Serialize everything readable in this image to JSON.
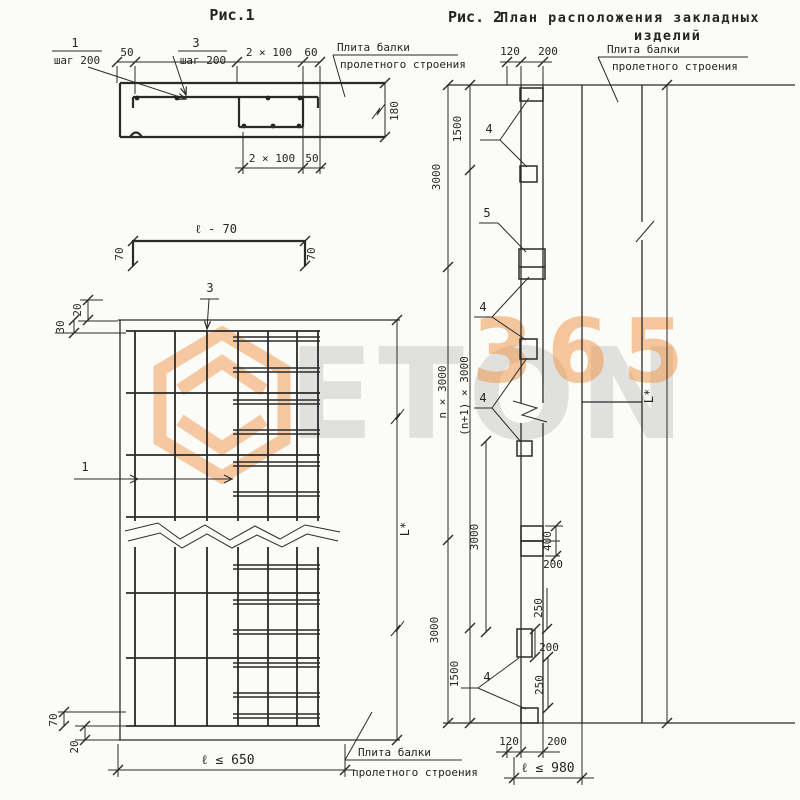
{
  "fig1": {
    "title": "Рис.1",
    "section": {
      "pos1": "1",
      "pos1_step": "шаг 200",
      "pos3": "3",
      "pos3_step": "шаг 200",
      "dim_50_top": "50",
      "dim_2x100_top": "2 × 100",
      "dim_60": "60",
      "plate_line1": "Плита балки",
      "plate_line2": "пролетного строения",
      "dim_180": "180",
      "dim_2x100_bottom": "2 × 100",
      "dim_50_bottom": "50"
    },
    "channel": {
      "dim_length": "ℓ - 70",
      "dim_70_left": "70",
      "dim_70_right": "70"
    },
    "plan": {
      "pos3": "3",
      "pos1": "1",
      "dim_20_top": "20",
      "dim_30": "30",
      "dim_L": "L*",
      "dim_70": "70",
      "dim_20_bottom": "20",
      "dim_length": "ℓ ≤ 650",
      "plate_line1": "Плита балки",
      "plate_line2": "пролетного строения"
    }
  },
  "fig2": {
    "title": "Рис. 2",
    "subtitle_line1": "План расположения закладных",
    "subtitle_line2": "изделий",
    "plate_line1": "Плита балки",
    "plate_line2": "пролетного строения",
    "dim_120_top": "120",
    "dim_200_top": "200",
    "dim_1500_top": "1500",
    "dim_3000_top": "3000",
    "dim_n": "n × 3000",
    "dim_n1": "(n+1) × 3000",
    "pos4_a": "4",
    "pos5": "5",
    "pos4_b": "4",
    "pos4_c": "4",
    "pos4_d": "4",
    "dim_3000_mid": "3000",
    "dim_400": "400",
    "dim_200_mid": "200",
    "dim_250_a": "250",
    "dim_200_right": "200",
    "dim_3000_bottom": "3000",
    "dim_1500_bottom": "1500",
    "dim_250_b": "250",
    "dim_120_bottom": "120",
    "dim_200_bottom": "200",
    "dim_length": "ℓ ≤ 980",
    "dim_L": "L*"
  },
  "watermark": {
    "brand": "ETON",
    "digits": "365"
  }
}
